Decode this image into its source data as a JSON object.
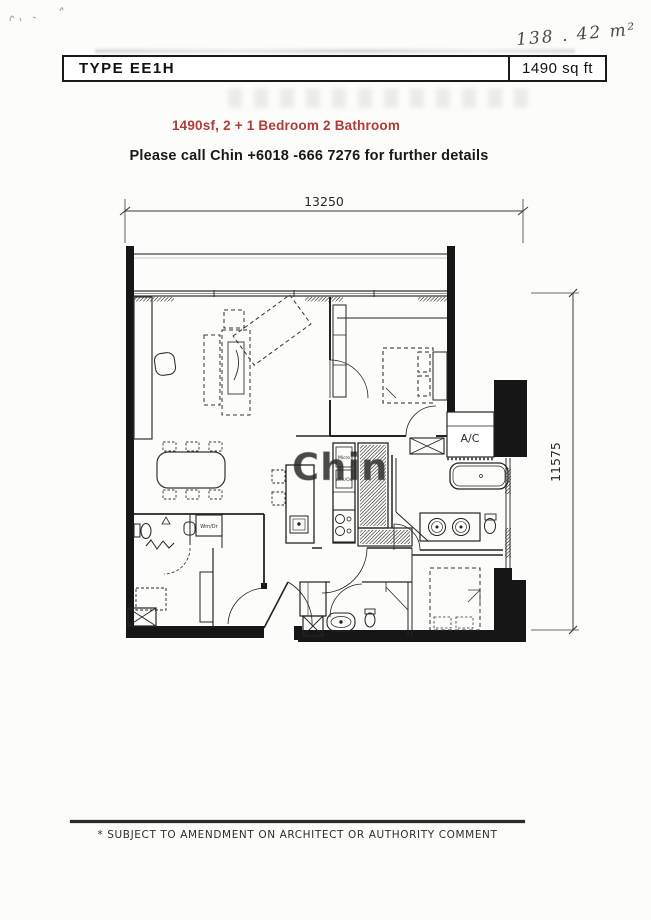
{
  "note": {
    "handwritten_area": "138 . 42 m²"
  },
  "header": {
    "type_label": "TYPE  EE1H",
    "area_label": "1490 sq ft"
  },
  "info": {
    "summary": "1490sf, 2 + 1 Bedroom 2 Bathroom",
    "contact": "Please call Chin +6018 -666 7276 for further details"
  },
  "plan": {
    "width_dim": "13250",
    "height_dim": "11575",
    "ac_label": "A/C",
    "washer_label": "Wm/Dr",
    "cabinet_label_1": "Micro",
    "cabinet_label_2": "Wm/Ov",
    "watermark": "Chin"
  },
  "footer": {
    "disclaimer": "* SUBJECT TO AMENDMENT ON ARCHITECT OR AUTHORITY COMMENT"
  },
  "colors": {
    "accent_red": "#b23b35",
    "ink": "#1a1a1a",
    "wall_black": "#161616",
    "watermark_gray": "#d0d0d0"
  }
}
